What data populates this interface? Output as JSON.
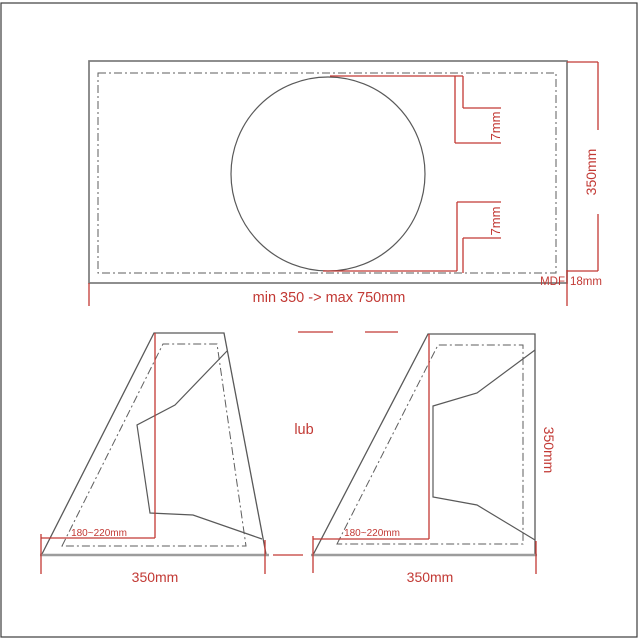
{
  "colors": {
    "dimension": "#c23934",
    "outline_gray": "#7a7a7a",
    "detail_gray": "#595959",
    "baseline_gray": "#9c9c9c"
  },
  "top_view": {
    "height_label": "350mm",
    "width_label": "min 350 -> max 750mm",
    "material_label": "MDF",
    "thickness_label": "18mm",
    "gap_top_label": "7mm",
    "gap_bottom_label": "7mm"
  },
  "left_side_view": {
    "depth_label": "180~220mm",
    "width_label": "350mm"
  },
  "or_label": "lub",
  "right_side_view": {
    "depth_label": "180~220mm",
    "width_label": "350mm",
    "height_label": "350mm"
  }
}
